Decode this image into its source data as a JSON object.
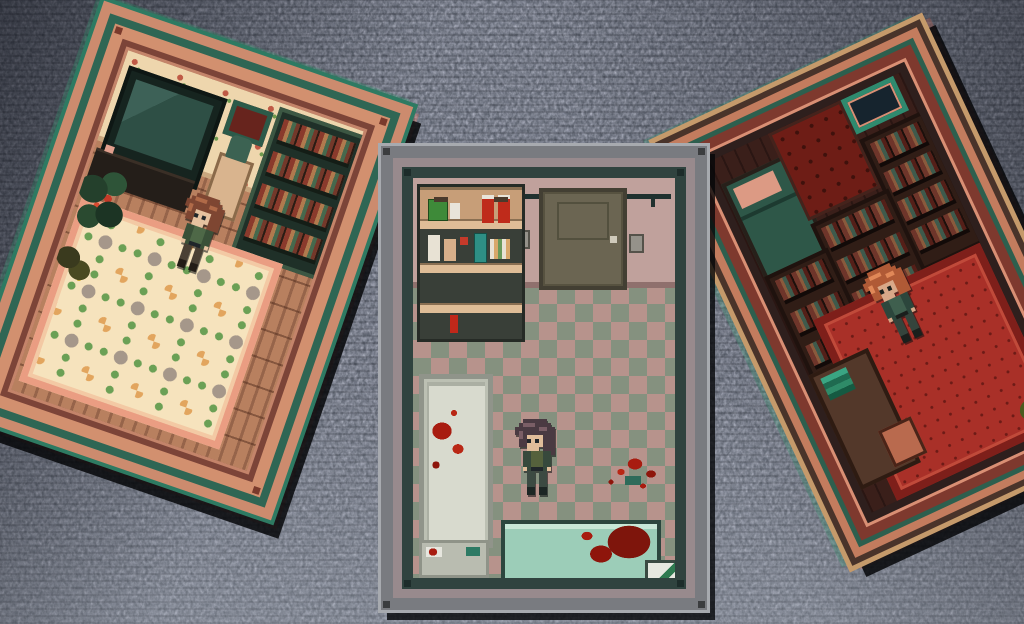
{
  "scene": {
    "label": "pixel-art horror RPG triptych cutscene",
    "background": {
      "texture": "tv-static-noise",
      "colors": {
        "base": "#4b515c",
        "dark": "#23262e",
        "light": "#9aa0a8"
      }
    },
    "shadow_color": "#08090c",
    "chromatic_ghost_colors": [
      "#2e9a6c",
      "#e1604a"
    ]
  },
  "panels": [
    {
      "label": "bedroom room panel (tilted clockwise)",
      "position": "left",
      "rotation_deg": 19,
      "frame_colors": [
        "#2e7a62",
        "#cc8b6e",
        "#2f6654",
        "#d2906f",
        "#7c4438",
        "#c4846a"
      ],
      "room": {
        "wallpaper_color": "#eed6ad",
        "wallpaper_pattern": "red-and-green floral sprigs",
        "floor": "vertical wood planks #b8805f",
        "rug": {
          "base": "#f6e3bd",
          "border": "#ea9d82",
          "accents": [
            "#a5978a",
            "#6ba055",
            "#e2a55e"
          ]
        },
        "objects": [
          "crt-tv",
          "tv-stand",
          "picture-frame",
          "bust-on-pedestal",
          "bookshelf-with-books",
          "flower-rug",
          "potted-plant-red-flowers",
          "potted-plant-yellow-flowers"
        ],
        "character": {
          "hair_color": "#b06a48",
          "skin_color": "#e6c2a0",
          "outfit_color": "#4e6847",
          "pose": "standing-front"
        }
      }
    },
    {
      "label": "bloody bathroom room panel (upright)",
      "position": "center",
      "rotation_deg": 0,
      "frame_colors": [
        "#a7aaaf",
        "#797b80",
        "#988a8d",
        "#30433f"
      ],
      "room": {
        "wall_color": "#c0a19c",
        "floor": "checkerboard tiles #b7938c and #85917f",
        "blood_color": "#a81c10",
        "objects": [
          "supply-shelf-with-cans",
          "door",
          "towel-rail",
          "wall-outlet",
          "wall-outlet",
          "bathtub-with-blood",
          "tub-step",
          "blood-splatter",
          "massage-table-with-blood-pool",
          "table-legs",
          "first-aid-box-bloody"
        ],
        "character": {
          "hair_color": "#4a3a42",
          "skin_color": "#e0bd9a",
          "outfit_color": "#55613c",
          "pose": "standing-front"
        }
      }
    },
    {
      "label": "dark study room panel (tilted counter-clockwise)",
      "position": "right",
      "rotation_deg": -25,
      "frame_colors": [
        "#c59a6b",
        "#49332a",
        "#c37c5e",
        "#2d5f4e",
        "#7e392e",
        "#d98f74",
        "#2e1f1d"
      ],
      "room": {
        "ambience": "dark red",
        "floor": "dark wood planks #3a1f1a",
        "carpet": {
          "base": "#a93028",
          "border": "#7e1f1a"
        },
        "objects": [
          "bed-with-pink-pillow",
          "red-dotted-wallpaper",
          "window-teal-frame",
          "bookcase",
          "bookcase",
          "bookcase",
          "red-carpet",
          "desk-with-teal-books",
          "chair",
          "potted-plant-yellow-flowers"
        ],
        "character": {
          "hair_color": "#d87c4e",
          "skin_color": "#d8a888",
          "outfit_color": "#3f5f4e",
          "pose": "standing-front"
        }
      }
    }
  ]
}
